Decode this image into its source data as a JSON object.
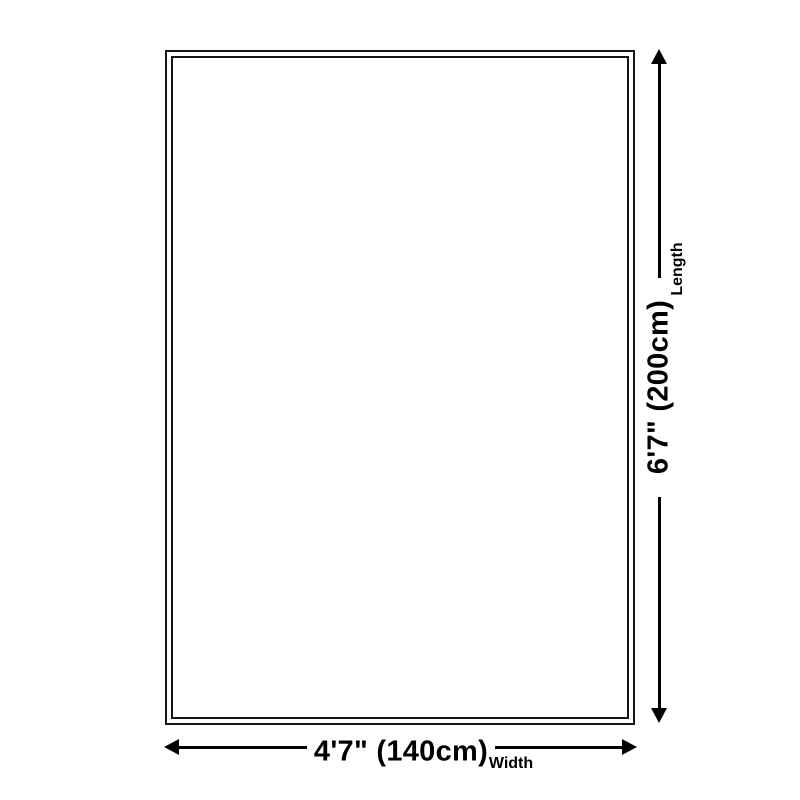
{
  "diagram": {
    "background_color": "#ffffff",
    "line_color": "#000000",
    "length": {
      "value": "6'7\" (200cm)",
      "label": "Length"
    },
    "width": {
      "value": "4'7\" (140cm)",
      "label": "Width"
    }
  }
}
